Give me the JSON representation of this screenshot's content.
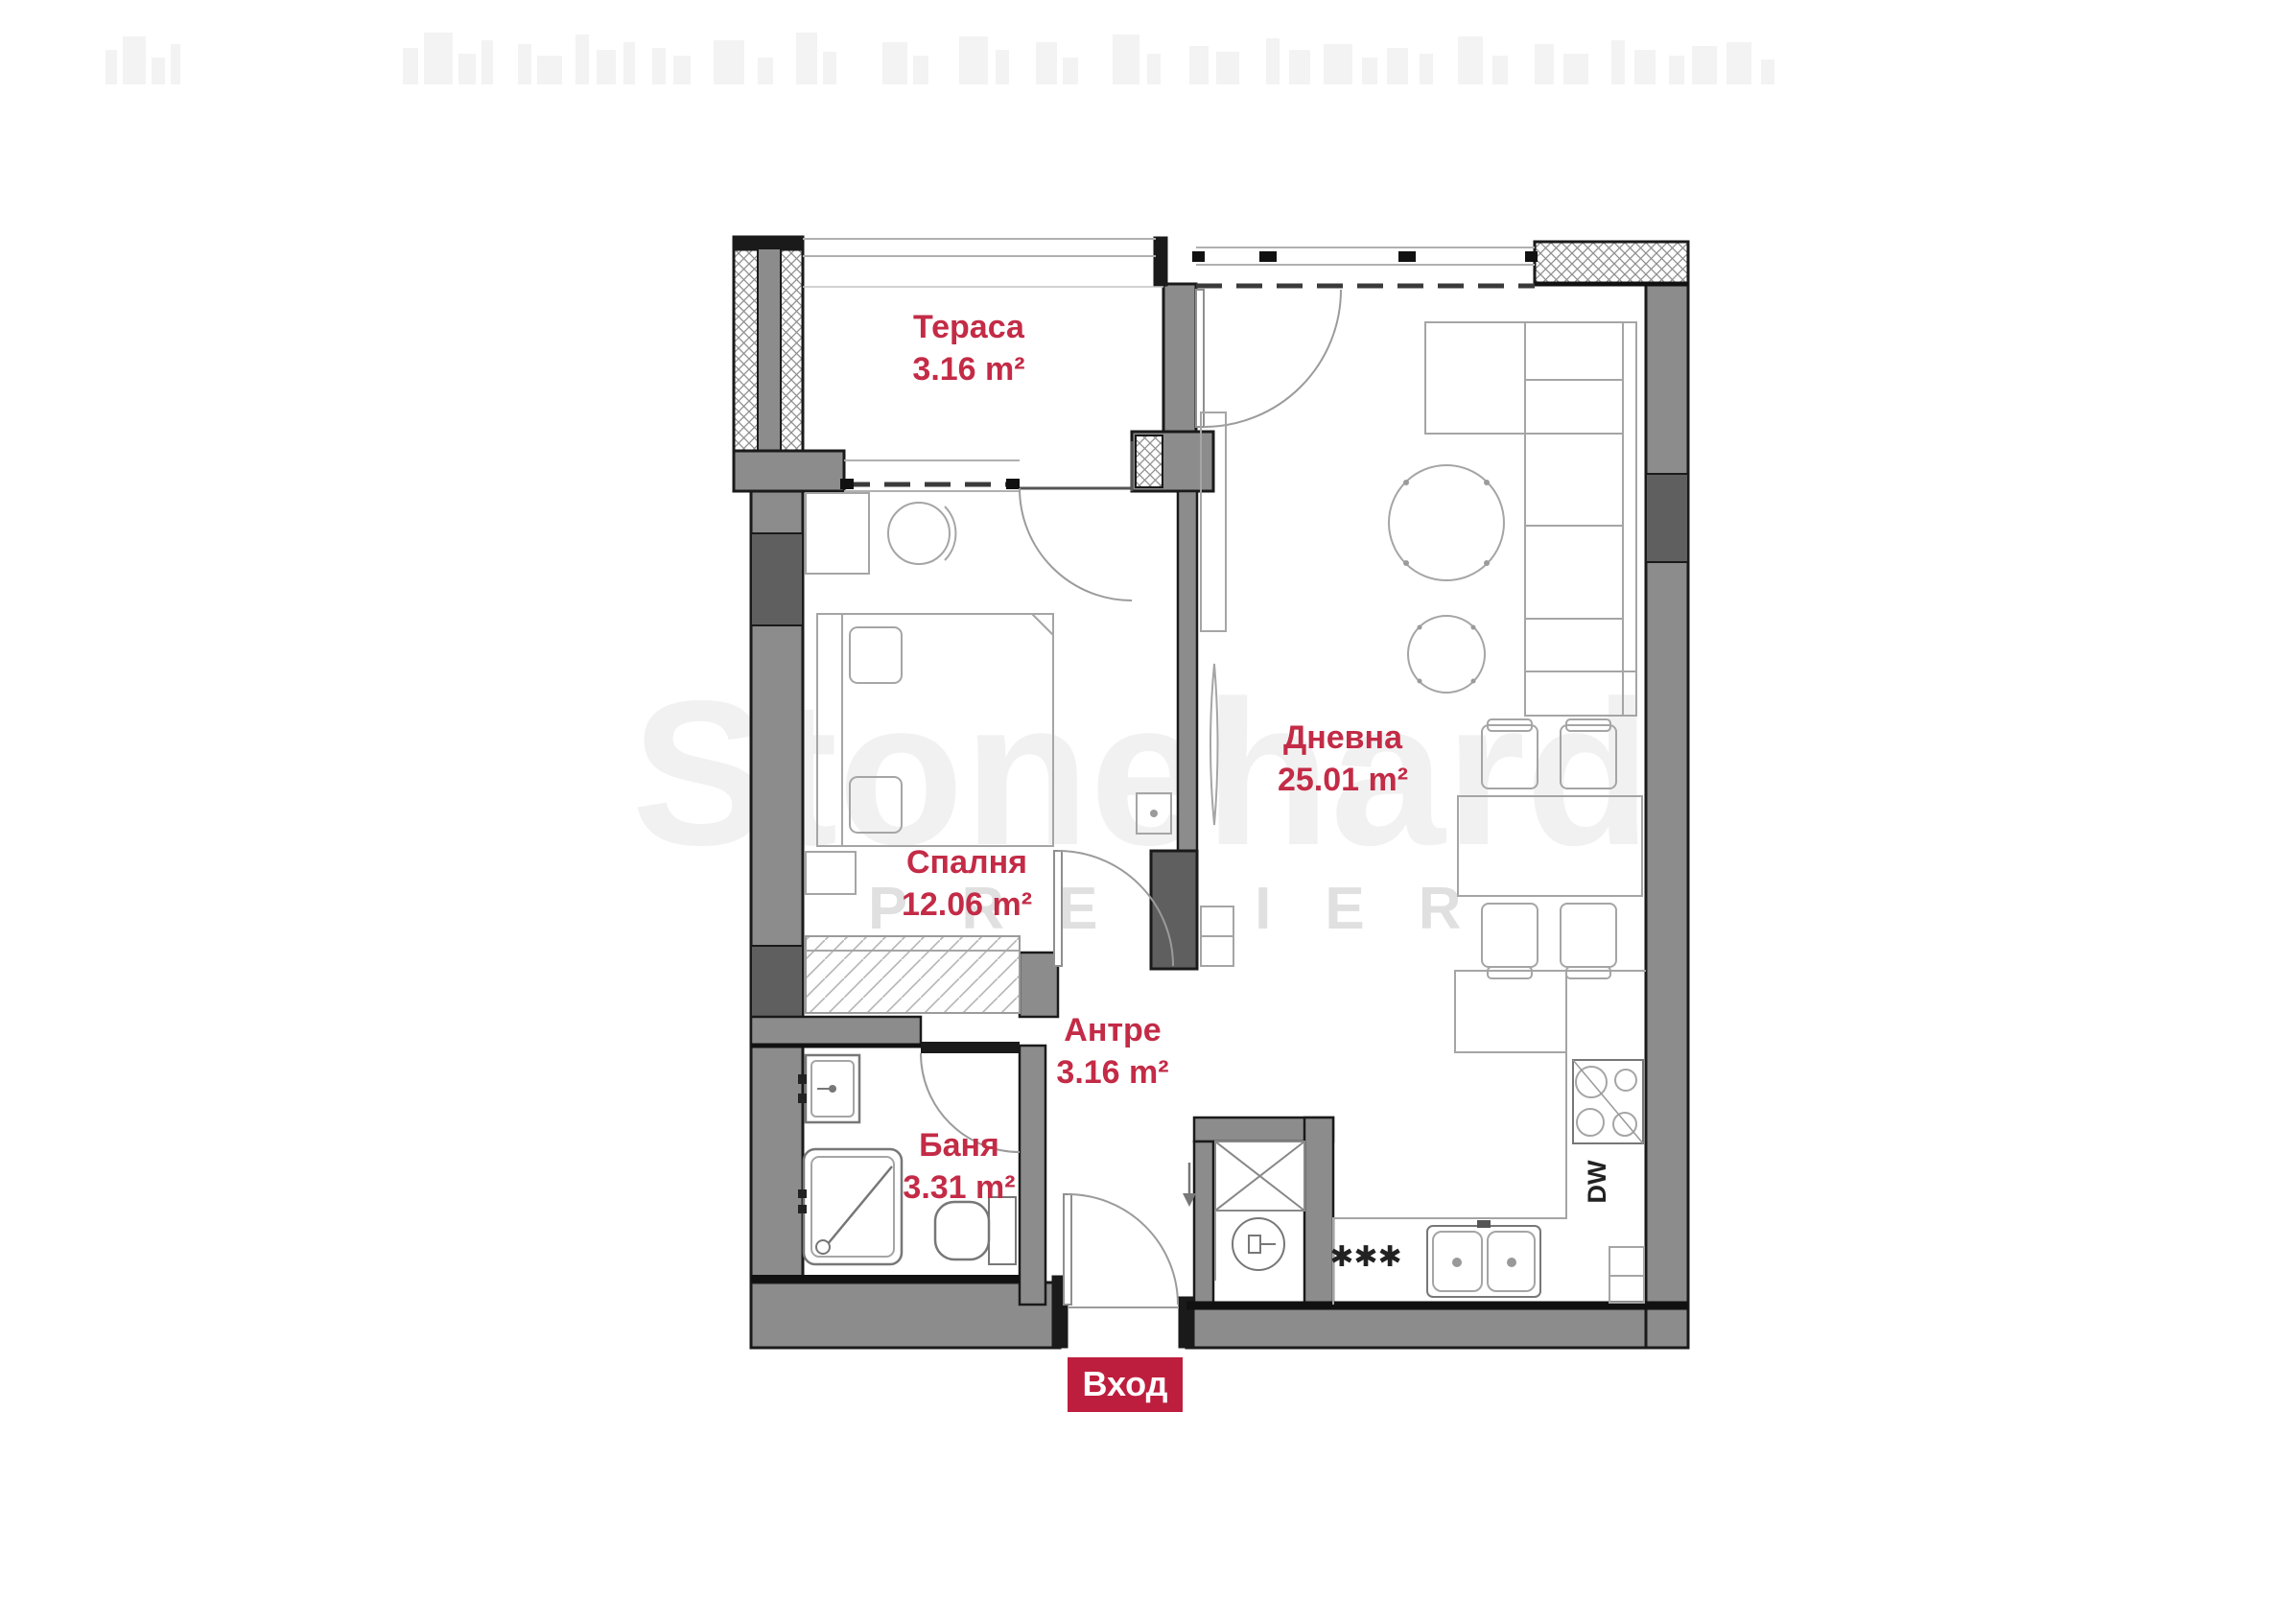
{
  "rooms": [
    {
      "id": "terrace",
      "name": "Тераса",
      "area": "3.16 m²"
    },
    {
      "id": "bedroom",
      "name": "Спалня",
      "area": "12.06 m²"
    },
    {
      "id": "living-room",
      "name": "Дневна",
      "area": "25.01 m²"
    },
    {
      "id": "hallway",
      "name": "Антре",
      "area": "3.16 m²"
    },
    {
      "id": "bathroom",
      "name": "Баня",
      "area": "3.31 m²"
    }
  ],
  "entrance": {
    "label": "Вход"
  },
  "appliances": {
    "dishwasher": "DW",
    "stove_marks": "✱✱✱"
  },
  "watermark": {
    "brand": "Stonehard",
    "tagline": "PREMIER"
  },
  "colors": {
    "label_red": "#c32b46",
    "badge_red": "#be1e3e",
    "wall_gray": "#8c8c8c",
    "wall_dark": "#5f5f5f",
    "outline": "#1a1a1a"
  }
}
